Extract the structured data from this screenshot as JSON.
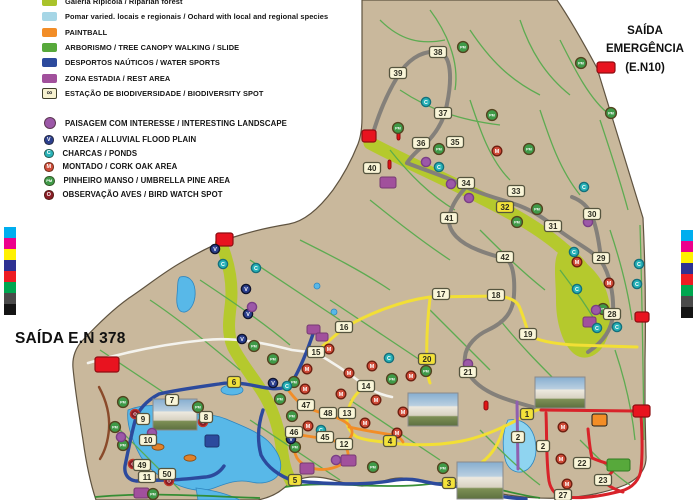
{
  "titles": {
    "exit_left": "SAÍDA E.N 378",
    "exit_emergency": [
      "SAÍDA",
      "EMERGÊNCIA",
      "(E.N10)"
    ]
  },
  "legend_areas": [
    {
      "label": "Galeria Ripícola / Riparian forest",
      "color": "#a9c32b"
    },
    {
      "label": "Pomar varied. locais e regionais / Ochard with local and regional species",
      "color": "#a6d6e6"
    },
    {
      "label": "PAINTBALL",
      "color": "#f28d27"
    },
    {
      "label": "ARBORISMO / TREE CANOPY WALKING / SLIDE",
      "color": "#57a93b"
    },
    {
      "label": "DESPORTOS NAÚTICOS / WATER SPORTS",
      "color": "#2c4a9d"
    },
    {
      "label": "ZONA ESTADIA / REST AREA",
      "color": "#a1509c"
    },
    {
      "label": "ESTAÇÃO DE BIODIVERSIDADE / BIODIVERSITY SPOT",
      "color": "#f6f1cf",
      "icon": "infinity"
    }
  ],
  "legend_points": [
    {
      "label": "PAISAGEM COM INTERESSE / INTERESTING LANDSCAPE",
      "color": "#9c58a8",
      "letter": ""
    },
    {
      "label": "VARZEA / ALLUVIAL FLOOD PLAIN",
      "color": "#2b3f8e",
      "letter": "V"
    },
    {
      "label": "CHARCAS / PONDS",
      "color": "#27b2b8",
      "letter": "C"
    },
    {
      "label": "MONTADO / CORK OAK AREA",
      "color": "#cf4b38",
      "letter": "M"
    },
    {
      "label": "PINHEIRO MANSO / UMBRELLA PINE AREA",
      "color": "#3f9a48",
      "letter": "PM"
    },
    {
      "label": "OBSERVAÇÃO AVES / BIRD WATCH SPOT",
      "color": "#8a1c26",
      "letter": "O"
    }
  ],
  "calibration_colors": [
    "#00aeef",
    "#ec008c",
    "#fff100",
    "#2e3192",
    "#ed1c24",
    "#00a650",
    "#4a4a4a",
    "#141414"
  ],
  "map": {
    "numbered_markers": [
      [
        "38",
        438,
        52,
        "c"
      ],
      [
        "39",
        398,
        73,
        "c"
      ],
      [
        "37",
        443,
        113,
        "c"
      ],
      [
        "36",
        421,
        143,
        "c"
      ],
      [
        "35",
        455,
        142,
        "c"
      ],
      [
        "40",
        372,
        168,
        "c"
      ],
      [
        "34",
        466,
        183,
        "c"
      ],
      [
        "33",
        516,
        191,
        "c"
      ],
      [
        "32",
        505,
        207,
        "y"
      ],
      [
        "41",
        449,
        218,
        "c"
      ],
      [
        "42",
        505,
        257,
        "c"
      ],
      [
        "31",
        553,
        226,
        "c"
      ],
      [
        "30",
        592,
        214,
        "c"
      ],
      [
        "29",
        601,
        258,
        "c"
      ],
      [
        "28",
        612,
        314,
        "c"
      ],
      [
        "17",
        441,
        294,
        "c"
      ],
      [
        "18",
        496,
        295,
        "c"
      ],
      [
        "16",
        344,
        327,
        "c"
      ],
      [
        "19",
        528,
        334,
        "c"
      ],
      [
        "15",
        316,
        352,
        "c"
      ],
      [
        "20",
        427,
        359,
        "y"
      ],
      [
        "21",
        468,
        372,
        "c"
      ],
      [
        "14",
        366,
        386,
        "c"
      ],
      [
        "6",
        234,
        382,
        "y"
      ],
      [
        "7",
        172,
        400,
        "c"
      ],
      [
        "8",
        206,
        417,
        "c"
      ],
      [
        "9",
        143,
        419,
        "c"
      ],
      [
        "10",
        148,
        440,
        "c"
      ],
      [
        "49",
        142,
        465,
        "c"
      ],
      [
        "11",
        147,
        477,
        "c"
      ],
      [
        "50",
        167,
        474,
        "c"
      ],
      [
        "47",
        306,
        405,
        "c"
      ],
      [
        "48",
        328,
        413,
        "c"
      ],
      [
        "13",
        347,
        413,
        "c"
      ],
      [
        "46",
        294,
        432,
        "c"
      ],
      [
        "45",
        325,
        437,
        "c"
      ],
      [
        "12",
        344,
        444,
        "c"
      ],
      [
        "4",
        390,
        441,
        "y"
      ],
      [
        "5",
        295,
        480,
        "y"
      ],
      [
        "3",
        449,
        483,
        "y"
      ],
      [
        "1",
        527,
        414,
        "y"
      ],
      [
        "2",
        518,
        437,
        "c"
      ],
      [
        "2",
        543,
        446,
        "c"
      ],
      [
        "22",
        582,
        463,
        "c"
      ],
      [
        "23",
        603,
        480,
        "c"
      ],
      [
        "27",
        563,
        495,
        "c"
      ]
    ],
    "point_markers": [
      [
        "PM",
        463,
        47
      ],
      [
        "PM",
        581,
        63
      ],
      [
        "PM",
        611,
        113
      ],
      [
        "PM",
        492,
        115
      ],
      [
        "PM",
        398,
        128
      ],
      [
        "PM",
        439,
        149
      ],
      [
        "PM",
        529,
        149
      ],
      [
        "PM",
        537,
        209
      ],
      [
        "PM",
        517,
        222
      ],
      [
        "PM",
        426,
        371
      ],
      [
        "PM",
        392,
        379
      ],
      [
        "PM",
        254,
        346
      ],
      [
        "PM",
        273,
        359
      ],
      [
        "PM",
        294,
        382
      ],
      [
        "PM",
        280,
        399
      ],
      [
        "PM",
        292,
        416
      ],
      [
        "PM",
        123,
        402
      ],
      [
        "PM",
        115,
        427
      ],
      [
        "PM",
        123,
        445
      ],
      [
        "PM",
        198,
        407
      ],
      [
        "PM",
        153,
        494
      ],
      [
        "PM",
        603,
        309
      ],
      [
        "PM",
        373,
        467
      ],
      [
        "PM",
        443,
        468
      ],
      [
        "PM",
        295,
        447
      ],
      [
        "M",
        497,
        151
      ],
      [
        "M",
        307,
        369
      ],
      [
        "M",
        305,
        389
      ],
      [
        "M",
        329,
        349
      ],
      [
        "M",
        349,
        373
      ],
      [
        "M",
        372,
        366
      ],
      [
        "M",
        411,
        376
      ],
      [
        "M",
        341,
        394
      ],
      [
        "M",
        376,
        400
      ],
      [
        "M",
        403,
        412
      ],
      [
        "M",
        397,
        433
      ],
      [
        "M",
        308,
        426
      ],
      [
        "M",
        365,
        423
      ],
      [
        "M",
        563,
        427
      ],
      [
        "M",
        561,
        459
      ],
      [
        "M",
        567,
        484
      ],
      [
        "M",
        577,
        262
      ],
      [
        "M",
        609,
        283
      ],
      [
        "C",
        426,
        102
      ],
      [
        "C",
        439,
        167
      ],
      [
        "C",
        584,
        187
      ],
      [
        "C",
        574,
        252
      ],
      [
        "C",
        577,
        289
      ],
      [
        "C",
        597,
        328
      ],
      [
        "C",
        617,
        327
      ],
      [
        "C",
        639,
        264
      ],
      [
        "C",
        637,
        284
      ],
      [
        "C",
        223,
        264
      ],
      [
        "C",
        256,
        268
      ],
      [
        "C",
        287,
        386
      ],
      [
        "C",
        321,
        430
      ],
      [
        "C",
        389,
        358
      ],
      [
        "V",
        215,
        249
      ],
      [
        "V",
        246,
        289
      ],
      [
        "V",
        248,
        314
      ],
      [
        "V",
        242,
        339
      ],
      [
        "V",
        273,
        383
      ],
      [
        "V",
        291,
        439
      ],
      [
        "O",
        135,
        414
      ],
      [
        "O",
        203,
        422
      ],
      [
        "O",
        133,
        464
      ],
      [
        "O",
        169,
        481
      ],
      [
        "P",
        451,
        184
      ],
      [
        "P",
        469,
        198
      ],
      [
        "P",
        426,
        162
      ],
      [
        "P",
        588,
        222
      ],
      [
        "P",
        596,
        310
      ],
      [
        "P",
        468,
        364
      ],
      [
        "P",
        252,
        307
      ],
      [
        "P",
        121,
        437
      ],
      [
        "P",
        152,
        433
      ],
      [
        "P",
        336,
        460
      ]
    ],
    "exit_markers": [
      [
        95,
        357,
        24,
        15
      ],
      [
        597,
        62,
        18,
        11
      ],
      [
        362,
        130,
        14,
        12
      ],
      [
        216,
        233,
        17,
        13
      ],
      [
        635,
        312,
        14,
        10
      ],
      [
        633,
        405,
        17,
        12
      ]
    ],
    "area_rects": [
      [
        "rest",
        380,
        177,
        16,
        11
      ],
      [
        "rest",
        300,
        463,
        14,
        11
      ],
      [
        "rest",
        341,
        455,
        15,
        11
      ],
      [
        "rest",
        134,
        488,
        15,
        10
      ],
      [
        "rest",
        583,
        317,
        13,
        10
      ],
      [
        "rest",
        307,
        325,
        13,
        9
      ],
      [
        "rest",
        316,
        333,
        12,
        8
      ],
      [
        "paintball",
        592,
        414,
        15,
        12
      ],
      [
        "arborismo",
        607,
        459,
        23,
        12
      ],
      [
        "deepwater",
        205,
        435,
        14,
        12
      ],
      [
        "redtick",
        397,
        131,
        3,
        9
      ],
      [
        "redtick",
        388,
        160,
        3,
        9
      ],
      [
        "redtick",
        484,
        401,
        4,
        9
      ]
    ],
    "photos": [
      [
        153,
        399,
        44,
        31
      ],
      [
        408,
        393,
        50,
        33
      ],
      [
        535,
        377,
        50,
        31
      ],
      [
        457,
        462,
        46,
        37
      ]
    ],
    "fish": [
      [
        158,
        447
      ],
      [
        190,
        458
      ]
    ]
  }
}
